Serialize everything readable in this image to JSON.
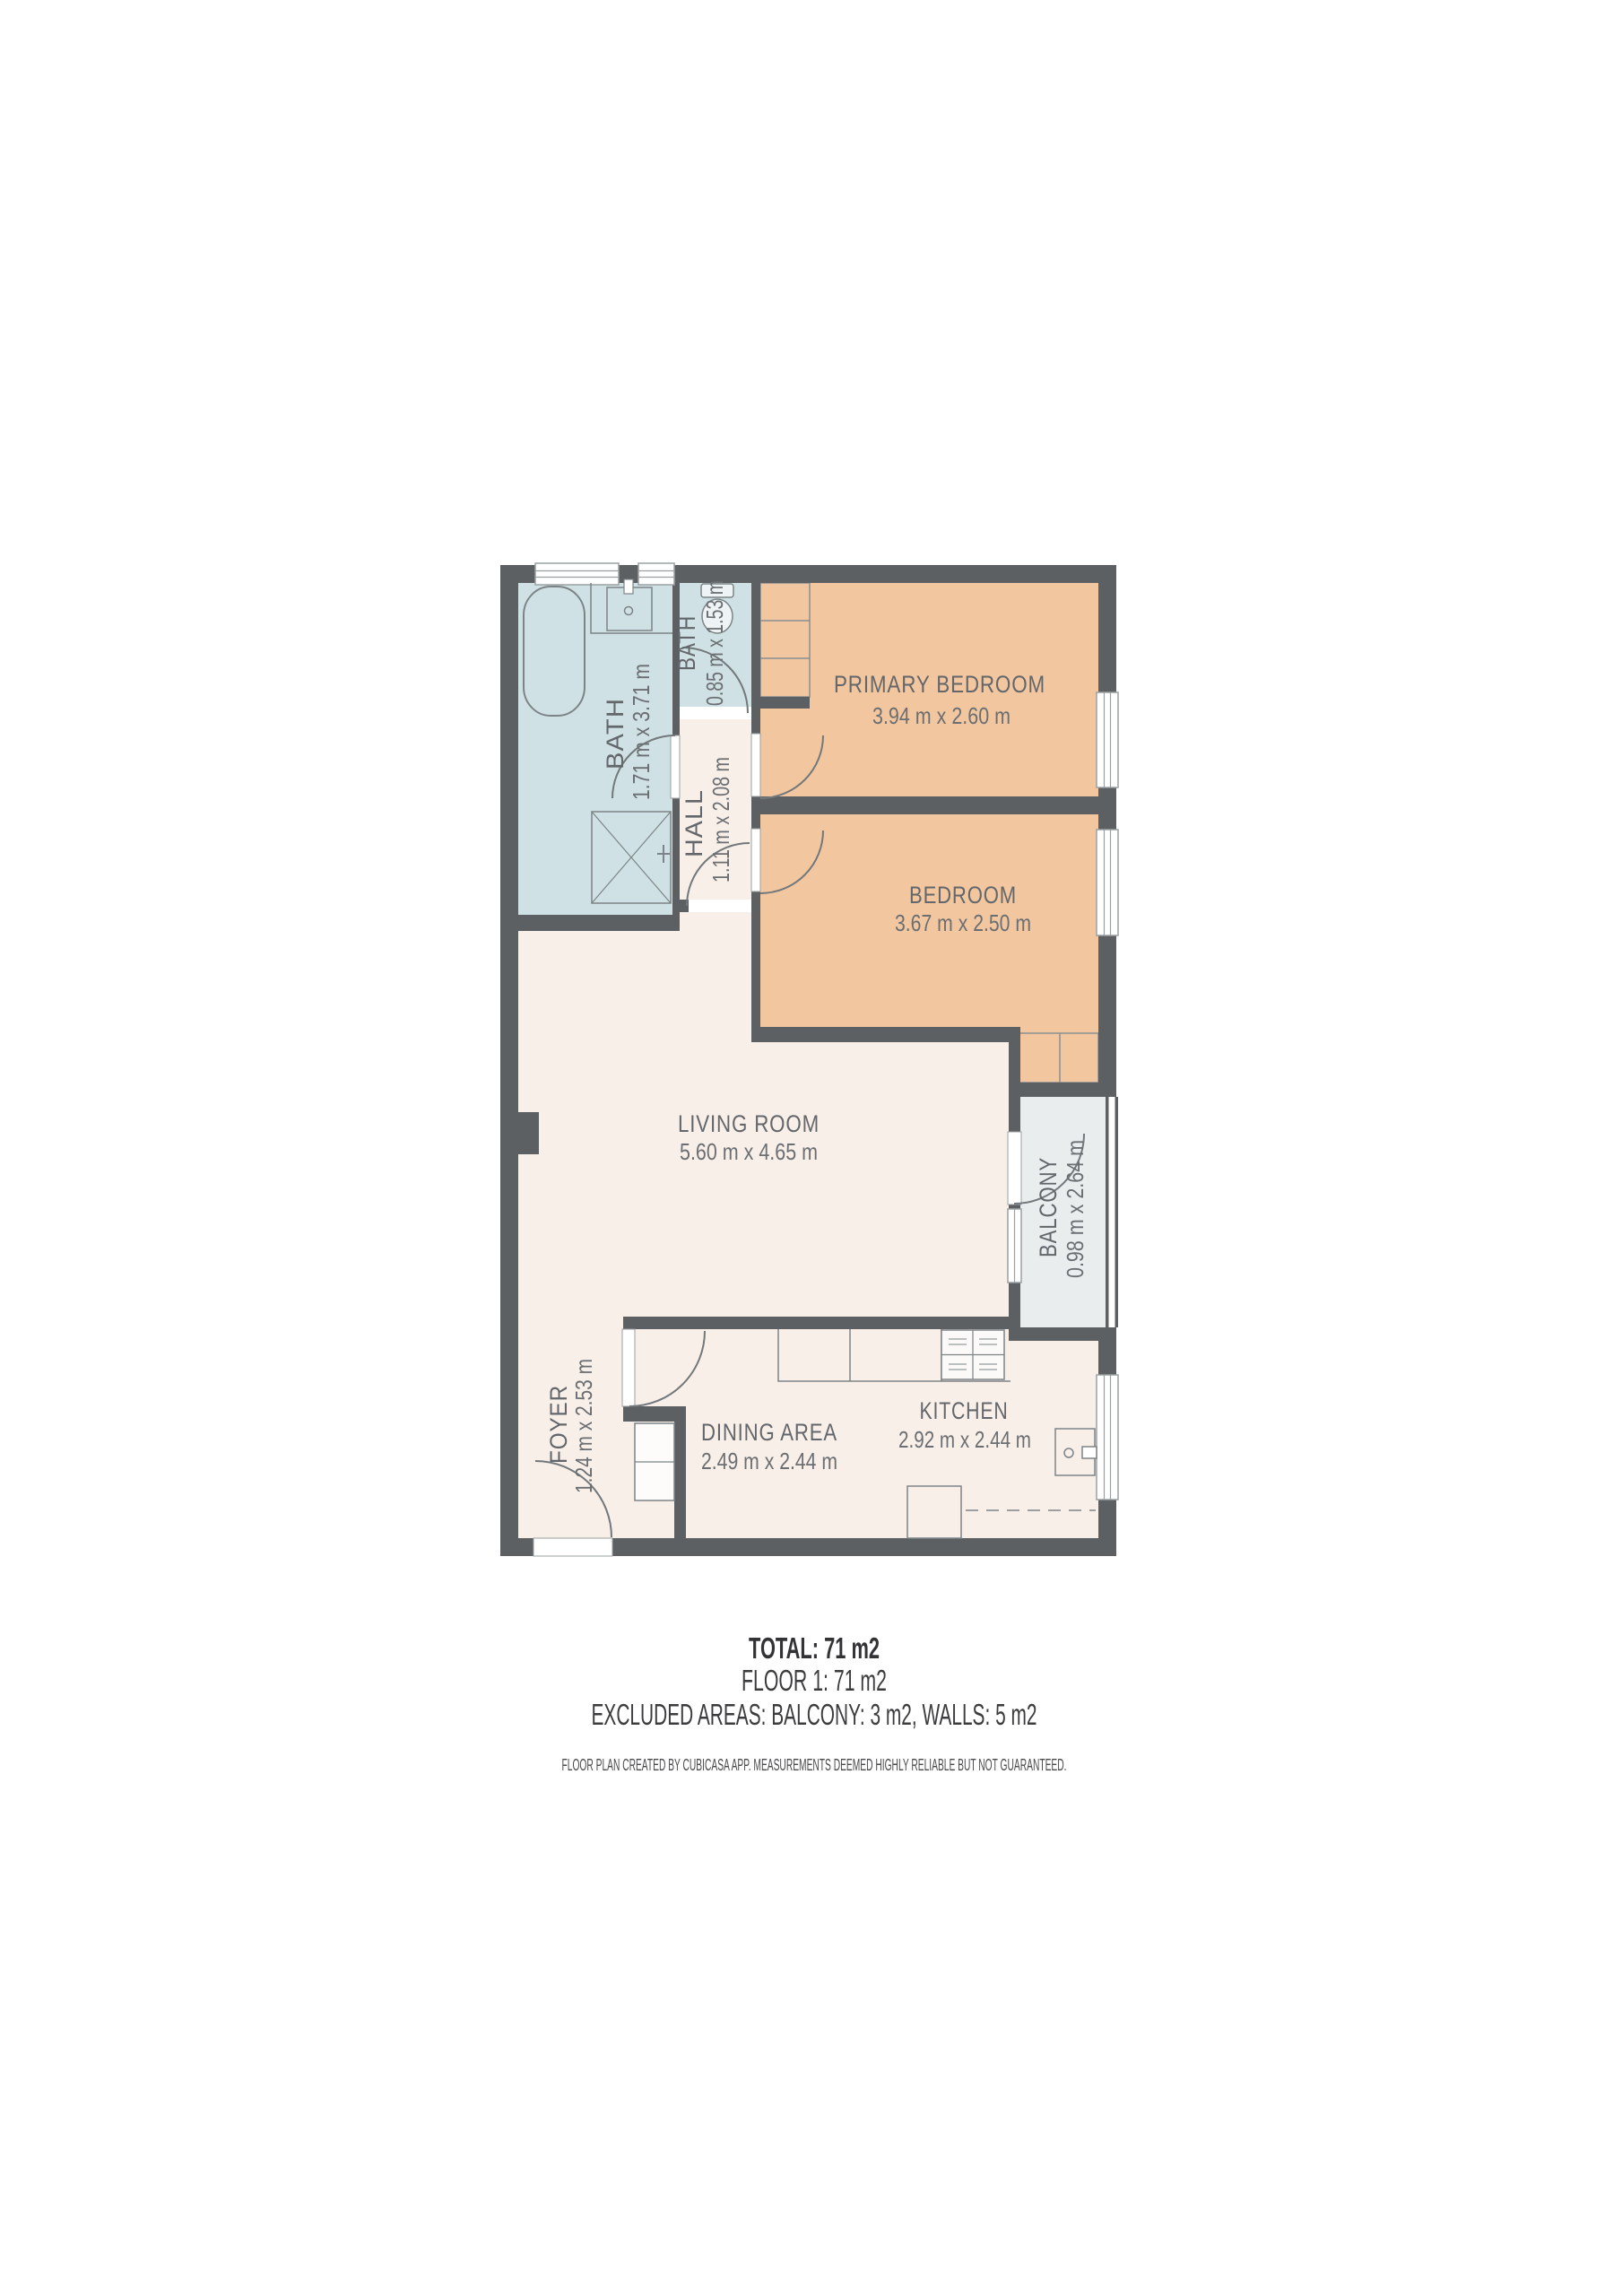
{
  "rooms": {
    "bath_large": {
      "label": "BATH",
      "dims": "1.71 m x 3.71 m"
    },
    "bath_small": {
      "label": "BATH",
      "dims": "0.85 m x 1.53 m"
    },
    "hall": {
      "label": "HALL",
      "dims": "1.11 m x 2.08 m"
    },
    "primary_bedroom": {
      "label": "PRIMARY BEDROOM",
      "dims": "3.94 m x 2.60 m"
    },
    "bedroom": {
      "label": "BEDROOM",
      "dims": "3.67 m x 2.50 m"
    },
    "living_room": {
      "label": "LIVING ROOM",
      "dims": "5.60 m x 4.65 m"
    },
    "balcony": {
      "label": "BALCONY",
      "dims": "0.98 m x 2.64 m"
    },
    "foyer": {
      "label": "FOYER",
      "dims": "1.24 m x 2.53 m"
    },
    "dining_area": {
      "label": "DINING AREA",
      "dims": "2.49 m x 2.44 m"
    },
    "kitchen": {
      "label": "KITCHEN",
      "dims": "2.92 m x 2.44 m"
    }
  },
  "summary": {
    "total": "TOTAL: 71 m2",
    "floor": "FLOOR 1: 71 m2",
    "excluded": "EXCLUDED AREAS: BALCONY: 3 m2, WALLS: 5 m2",
    "disclaimer": "FLOOR PLAN CREATED BY CUBICASA APP. MEASUREMENTS DEEMED HIGHLY RELIABLE BUT NOT GUARANTEED."
  },
  "colors": {
    "wall": "#5d6063",
    "floor_main": "#f8efe8",
    "floor_wet": "#cfe1e4",
    "floor_bedroom": "#f2c69f",
    "floor_balcony": "#e9edee",
    "fixture_outline": "#7d8487",
    "label_text": "#63676b",
    "summary_text": "#3c3c3e"
  }
}
